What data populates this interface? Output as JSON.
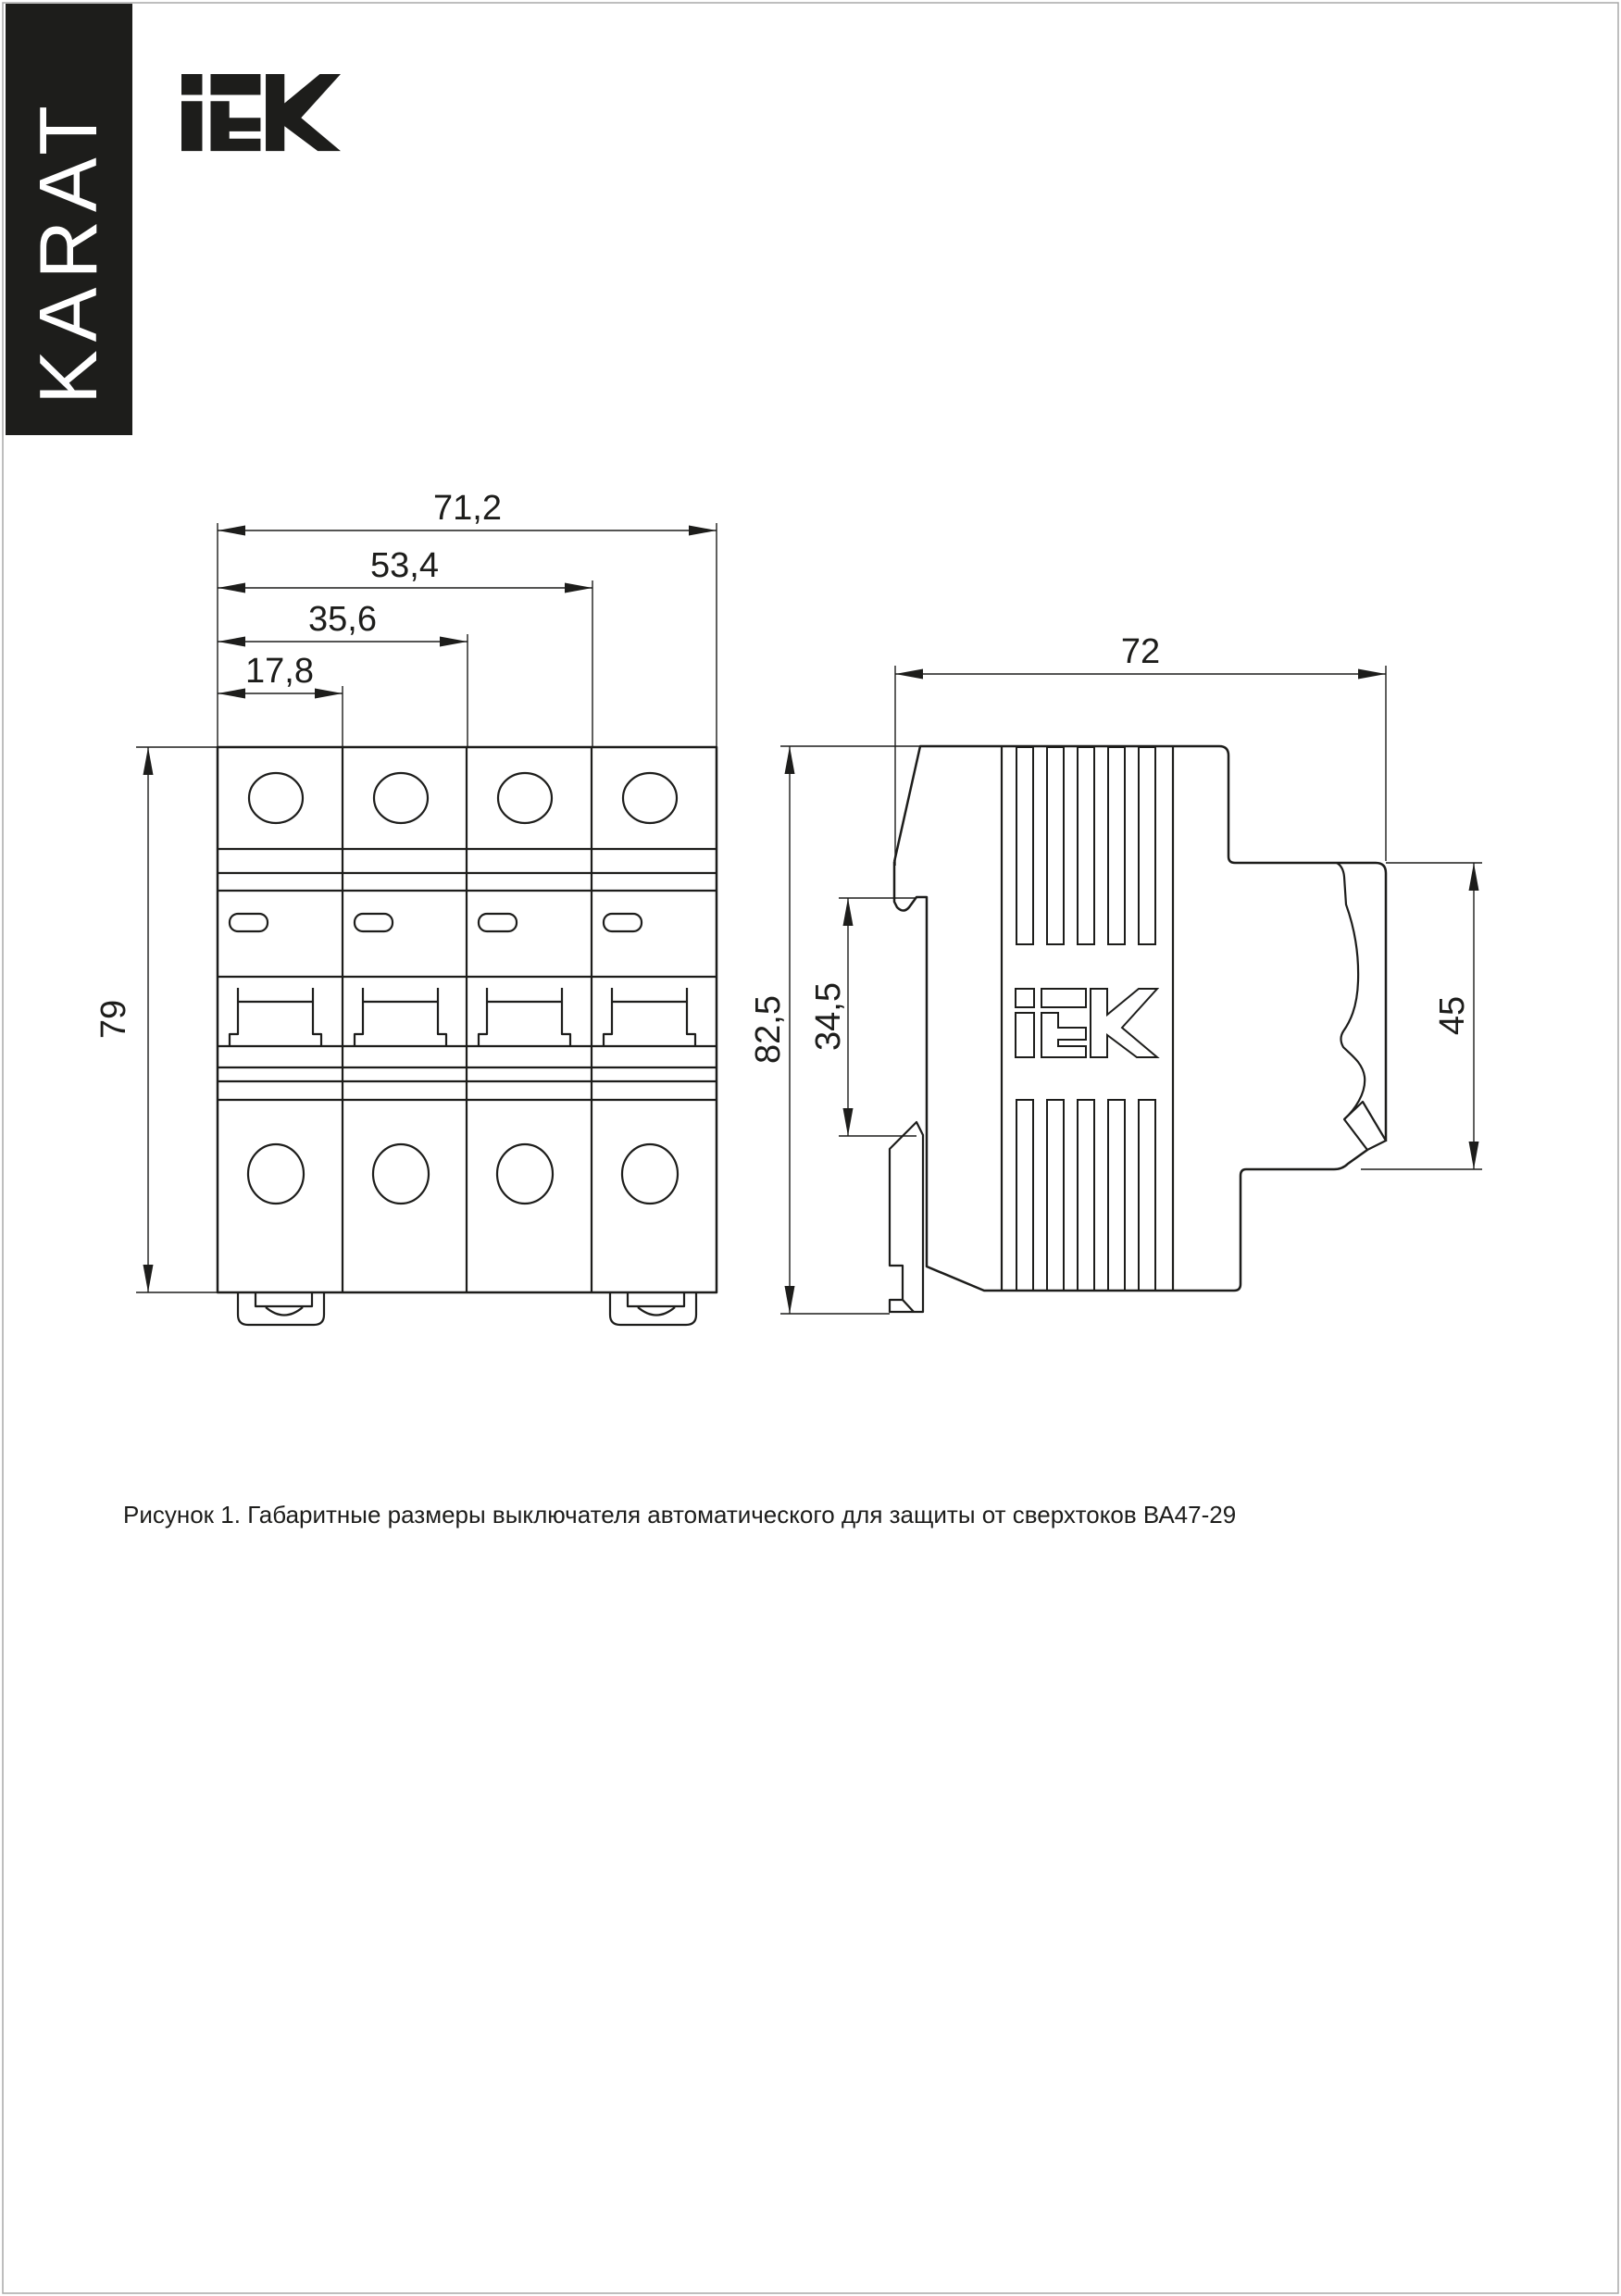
{
  "page": {
    "background": "#ffffff",
    "border_color": "#a8a8a8",
    "line_color": "#1d1d1b",
    "caption": "Рисунок 1. Габаритные размеры выключателя автоматического для защиты от сверхтоков ВА47-29"
  },
  "branding": {
    "banner_text": "KARAT",
    "banner_bg": "#1d1d1b",
    "banner_text_color": "#ffffff",
    "logo_name": "IEK"
  },
  "front_view": {
    "dim_width_total": "71,2",
    "dim_width_three_modules": "53,4",
    "dim_width_two_modules": "35,6",
    "dim_width_one_module": "17,8",
    "dim_height": "79"
  },
  "side_view": {
    "dim_depth": "72",
    "dim_height_total": "82,5",
    "dim_rail_recess": "34,5",
    "dim_front_section": "45"
  }
}
